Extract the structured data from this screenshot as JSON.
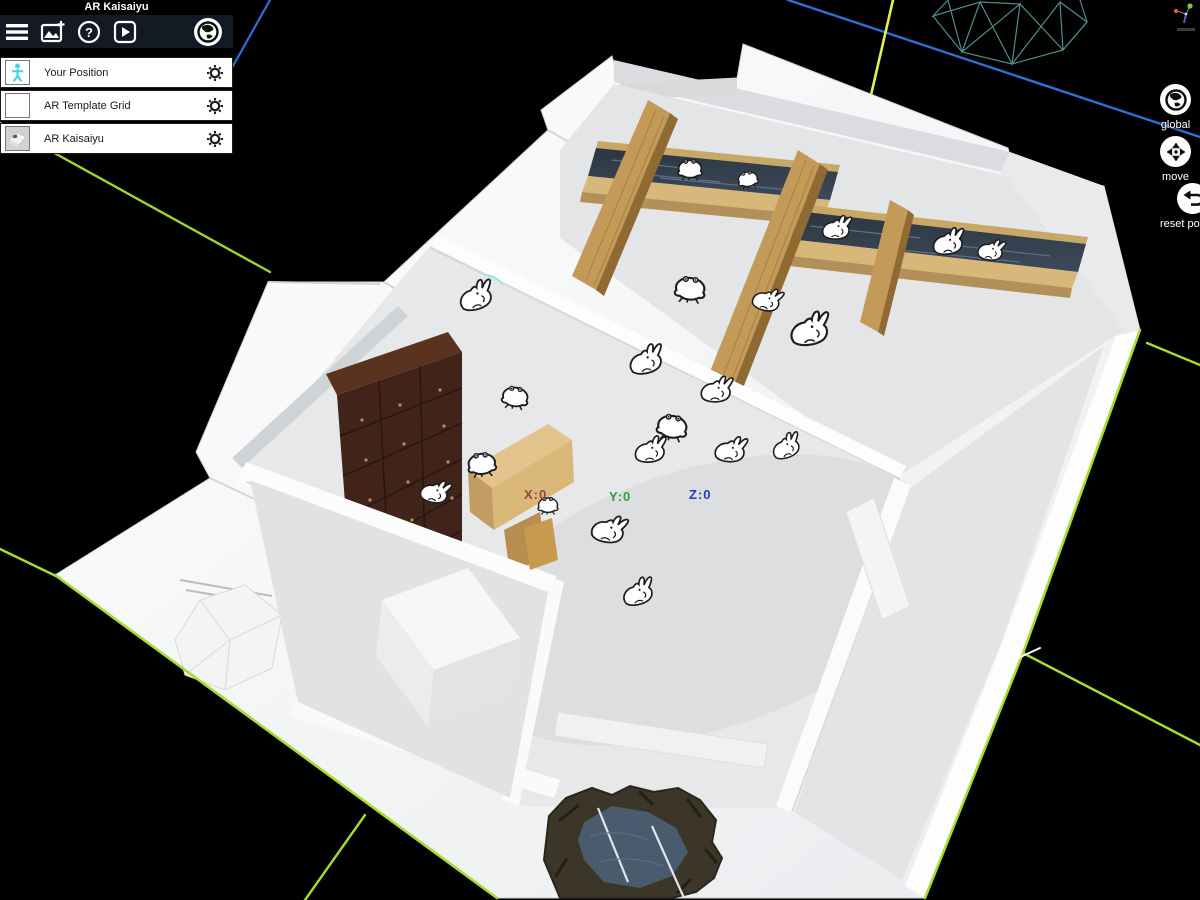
{
  "window": {
    "title": "AR Kaisaiyu"
  },
  "toolbar": {
    "buttons": [
      {
        "icon": "menu"
      },
      {
        "icon": "add-image"
      },
      {
        "icon": "help",
        "glyph": "?"
      },
      {
        "icon": "play"
      },
      {
        "icon": "globe"
      }
    ]
  },
  "layer_panel": {
    "items": [
      {
        "label": "Your Position",
        "thumbnail": "person-figure"
      },
      {
        "label": "AR Template Grid",
        "thumbnail": "blank"
      },
      {
        "label": "AR Kaisaiyu",
        "thumbnail": "model-preview"
      }
    ]
  },
  "view_controls": {
    "buttons": [
      {
        "label": "global",
        "icon": "globe"
      },
      {
        "label": "move",
        "icon": "move-arrows"
      },
      {
        "label": "reset position",
        "icon": "undo-arrow"
      }
    ]
  },
  "viewport": {
    "axis_readout": {
      "x_label": "X:0",
      "x_color": "#9c3f3f",
      "y_label": "Y:0",
      "y_color": "#2f9e44",
      "z_label": "Z:0",
      "z_color": "#2b35c8"
    },
    "grid_colors": {
      "green": "#a6dd2e",
      "blue": "#2f6fd6"
    },
    "scene_model": "AR Kaisaiyu bathhouse 3D model"
  }
}
